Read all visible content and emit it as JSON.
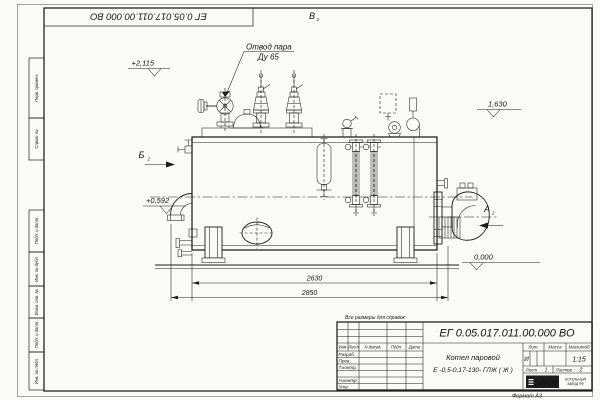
{
  "frame": {
    "top_stamp": "ЕГ 0.05.017.011.00.000 ВО",
    "format_label": "Формат А3",
    "side_labels": [
      "Перв. примен.",
      "Справ. №",
      "Подп. и дата",
      "Инв. № дубл.",
      "Взам. инв. №",
      "Подп. и дата",
      "Инв. № подл."
    ]
  },
  "note": "Все размеры для справок",
  "drawing": {
    "callout_line1": "Отвод пара",
    "callout_line2": "Ду 65",
    "view_b": "Б",
    "view_v": "В",
    "view_a": "А",
    "view_sheet_ref": "2",
    "elev_1": "+2,115",
    "elev_2": "+0,592",
    "elev_3": "1,630",
    "elev_4": "0,000",
    "dim_1": "2630",
    "dim_2": "2850"
  },
  "title_block": {
    "doc_number": "ЕГ 0.05.017.011.00.000 ВО",
    "name_line1": "Котел паровой",
    "name_line2": "Е -0,5-0,17-130- ГЛЖ ( Ж )",
    "col_izm": "Изм",
    "col_list": "Лист",
    "col_docum": "N докум.",
    "col_podp": "Подп.",
    "col_data": "Дата",
    "row_razrab": "Разраб.",
    "row_prov": "Пров.",
    "row_tkontr": "Т.контр.",
    "row_nkontr": "Н.контр.",
    "row_utv": "Утв.",
    "lit_label": "Лит.",
    "lit_value": "И",
    "massa_label": "Масса",
    "masshtab_label": "Масштаб",
    "masshtab_value": "1:15",
    "list_label": "Лист",
    "list_value": "1",
    "listov_label": "Листов",
    "listov_value": "2",
    "logo_text": "KVZR",
    "company_line1": "КОТЕЛЬНЫЙ",
    "company_line2": "ЗАВОД РФ"
  }
}
